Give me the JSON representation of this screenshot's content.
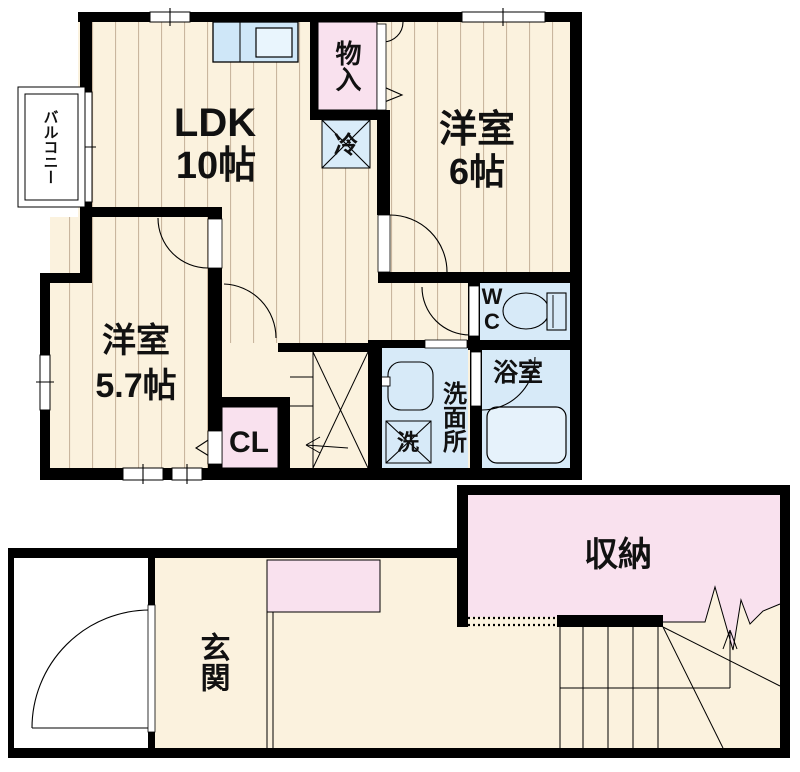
{
  "floor2": {
    "balcony_label": "バルコニー",
    "ldk_name": "LDK",
    "ldk_size": "10帖",
    "storage_label": "物入",
    "fridge_label": "冷",
    "bedroom6_name": "洋室",
    "bedroom6_size": "6帖",
    "bedroom57_name": "洋室",
    "bedroom57_size": "5.7帖",
    "closet_label": "CL",
    "wc_label": "WC",
    "washroom_label": "洗面所",
    "washer_label": "洗",
    "bath_label": "浴室"
  },
  "floor1": {
    "entrance_label": "玄関",
    "storage_label": "収納"
  },
  "colors": {
    "wall": "#000000",
    "floor_cream": "#fbf2de",
    "wood_grain_line": "#c9b69e",
    "wet_area_blue": "#d7eaf8",
    "storage_pink": "#f9e1ee",
    "counter_blue": "#cfe7f8",
    "tub_blue": "#e6f2fb"
  }
}
